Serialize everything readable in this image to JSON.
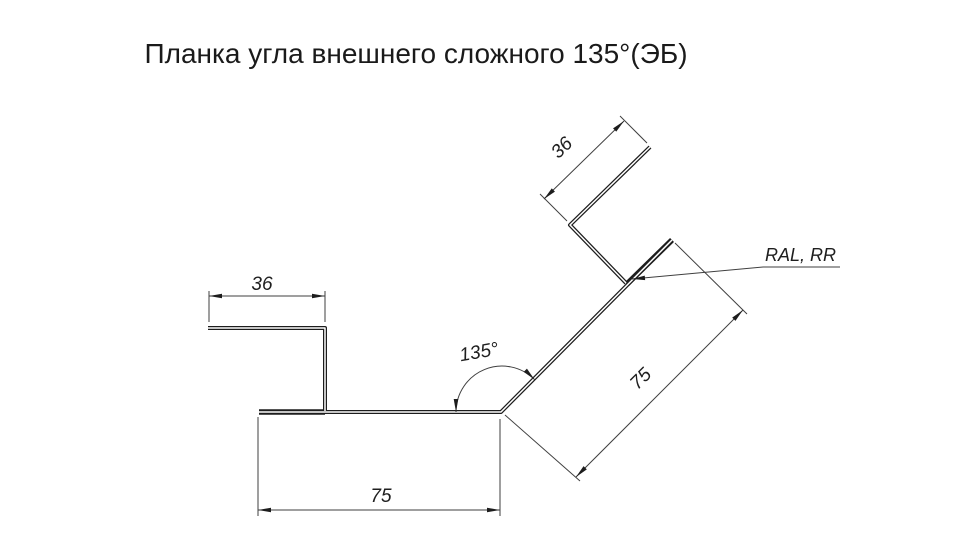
{
  "title": "Планка угла внешнего сложного 135°(ЭБ)",
  "dimensions": {
    "top_flange": "36",
    "bottom_flange": "75",
    "upper_right_flange": "36",
    "diagonal_flange": "75",
    "corner_angle": "135°"
  },
  "annotations": {
    "coating": "RAL, RR"
  }
}
